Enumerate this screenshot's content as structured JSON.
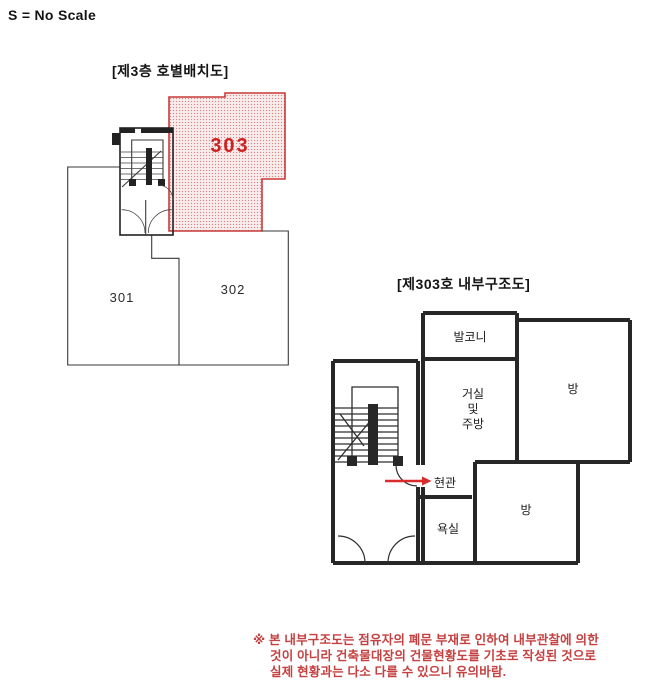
{
  "scale_note": "S = No Scale",
  "colors": {
    "accent_red": "#cc2222",
    "hatch_dot": "#d98383",
    "hatch_bg": "#f8ecec",
    "red_border": "#c93a3a",
    "wall_dark": "#272727",
    "outline": "#3a3a3a",
    "note_red": "#c54040"
  },
  "plan1": {
    "title": "[제3층 호별배치도]",
    "units": [
      {
        "label": "301",
        "highlighted": false
      },
      {
        "label": "302",
        "highlighted": false
      },
      {
        "label": "303",
        "highlighted": true
      }
    ]
  },
  "plan2": {
    "title": "[제303호 내부구조도]",
    "rooms": {
      "balcony": "발코니",
      "room_top": "방",
      "living_line1": "거실",
      "living_line2": "및",
      "living_line3": "주방",
      "entrance": "현관",
      "bathroom": "욕실",
      "room_bottom": "방"
    }
  },
  "footnote": {
    "lines": [
      "※ 본 내부구조도는 점유자의 폐문 부재로 인하여 내부관찰에 의한",
      "것이 아니라 건축물대장의 건물현황도를 기초로 작성된 것으로",
      "실제 현황과는 다소 다를 수 있으니 유의바람."
    ]
  }
}
